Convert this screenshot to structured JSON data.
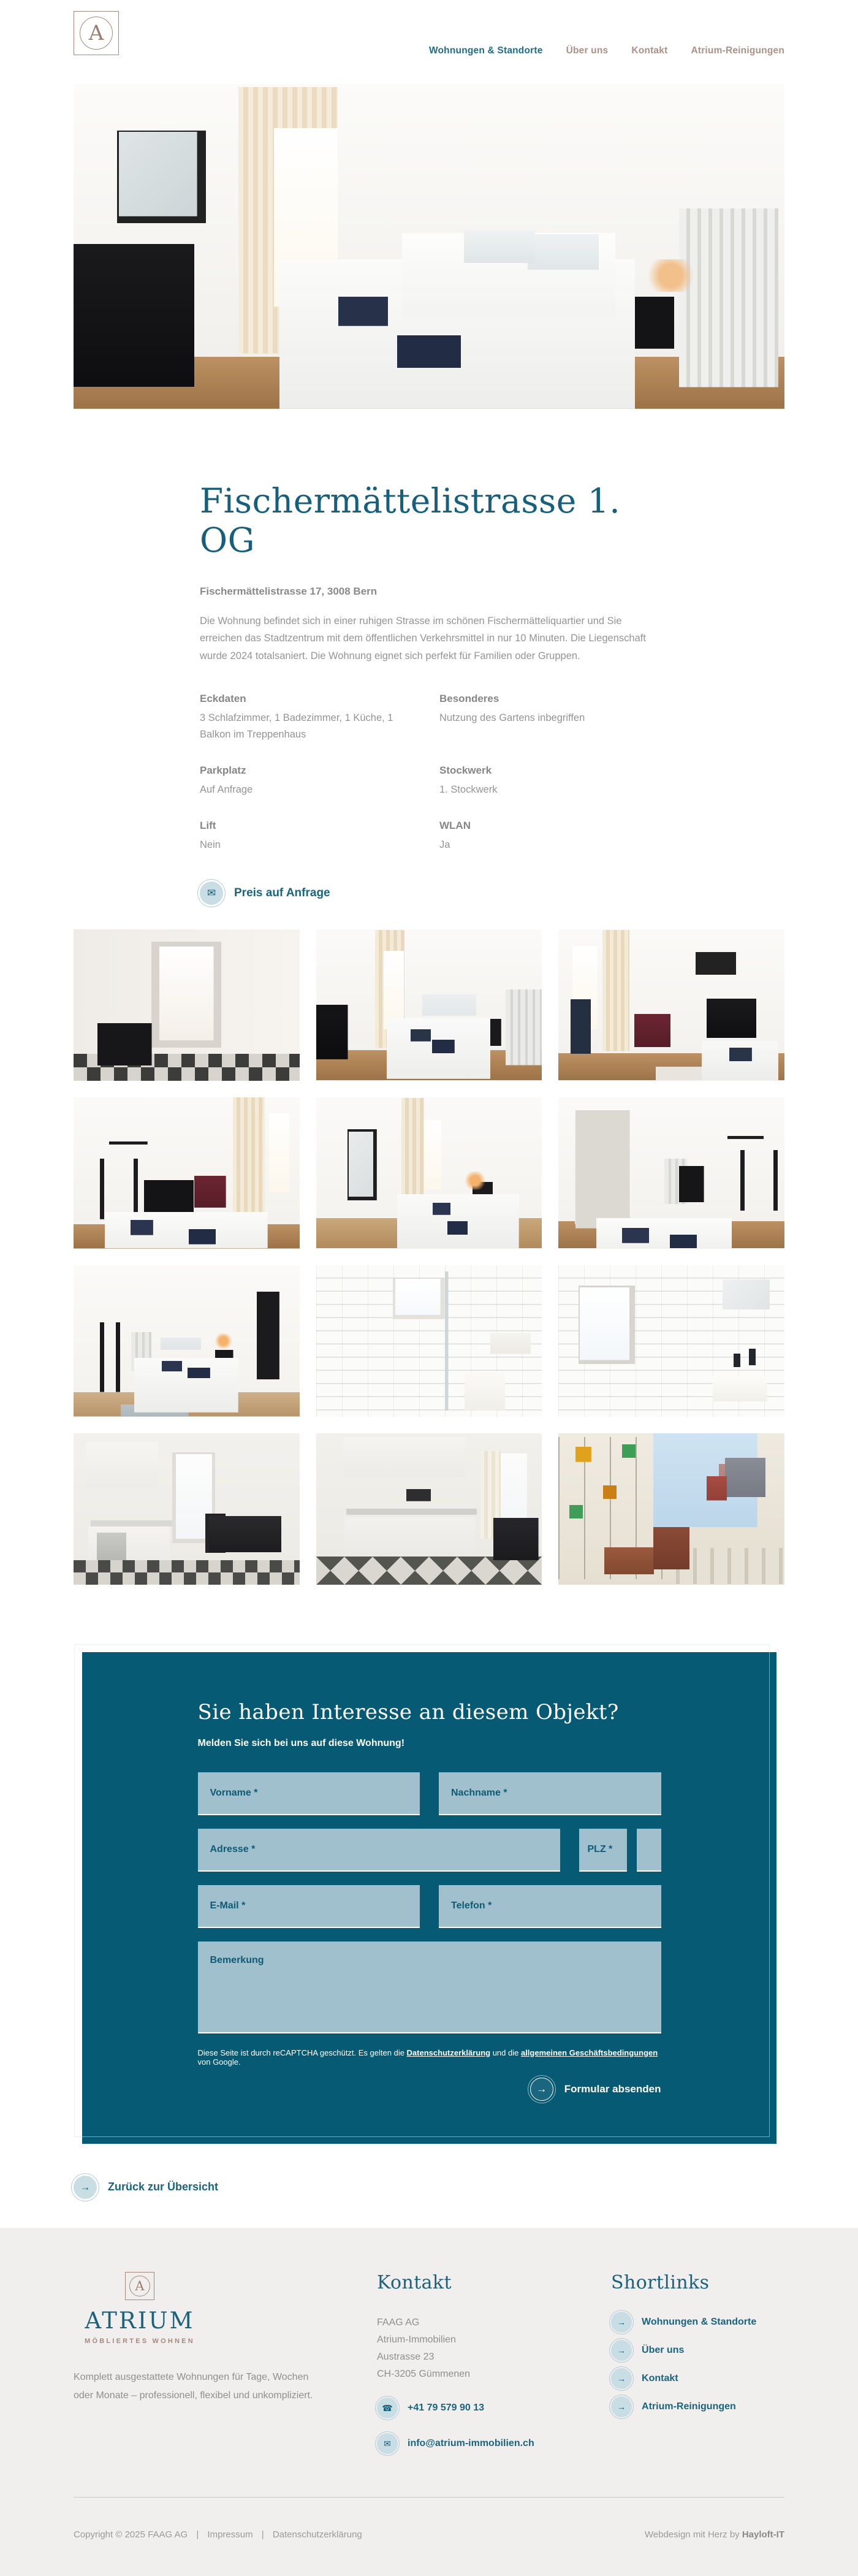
{
  "icons": {
    "envelope": "✉",
    "phone": "☎",
    "arrow": "→",
    "letter": "A"
  },
  "header": {
    "nav": [
      {
        "label": "Wohnungen & Standorte",
        "active": true
      },
      {
        "label": "Über uns",
        "active": false
      },
      {
        "label": "Kontakt",
        "active": false
      },
      {
        "label": "Atrium-Reinigungen",
        "active": false
      }
    ]
  },
  "hero": {
    "alt": "Schlafzimmer mit Doppelbett, schwarzer Kommode, Spiegel und Heizkörper"
  },
  "listing": {
    "title": "Fischermättelistrasse 1. OG",
    "address": "Fischermättelistrasse 17, 3008 Bern",
    "description": "Die Wohnung befindet sich in einer ruhigen Strasse im schönen Fischermätteliquartier und Sie erreichen das Stadtzentrum mit dem öffentlichen Verkehrsmittel in nur 10 Minuten. Die Liegenschaft wurde 2024 totalsaniert. Die Wohnung eignet sich perfekt für Familien oder Gruppen.",
    "details": [
      {
        "label": "Eckdaten",
        "value": "3 Schlafzimmer, 1 Badezimmer, 1 Küche, 1 Balkon im Treppenhaus"
      },
      {
        "label": "Besonderes",
        "value": "Nutzung des Gartens inbegriffen"
      },
      {
        "label": "Parkplatz",
        "value": "Auf Anfrage"
      },
      {
        "label": "Stockwerk",
        "value": "1. Stockwerk"
      },
      {
        "label": "Lift",
        "value": "Nein"
      },
      {
        "label": "WLAN",
        "value": "Ja"
      }
    ],
    "price_button": "Preis auf Anfrage"
  },
  "gallery": {
    "photos": [
      {
        "alt": "Flur mit Schachbrettboden und Konsole"
      },
      {
        "alt": "Schlafzimmer mit Bett und Heizkörper"
      },
      {
        "alt": "Schlafzimmer mit Kommode und rotem Sessel"
      },
      {
        "alt": "Schlafzimmer mit Kleiderständer und Reisebett"
      },
      {
        "alt": "Schlafzimmer mit Standspiegel und Betten"
      },
      {
        "alt": "Zimmer mit Schreibtisch, Stuhl und Kleiderständer"
      },
      {
        "alt": "Schlafzimmer mit Stativleuchte und Spiegel"
      },
      {
        "alt": "Badezimmer mit Dusche und WC"
      },
      {
        "alt": "Badezimmer mit Fenster und Lavabo"
      },
      {
        "alt": "Küche mit Esstisch und Schachbrettboden"
      },
      {
        "alt": "Küche mit Mikrowelle und Backofen"
      },
      {
        "alt": "Balkon mit Buntglasfenster und Holzstuhl"
      }
    ]
  },
  "form": {
    "title": "Sie haben Interesse an diesem Objekt?",
    "subtitle": "Melden Sie sich bei uns auf diese Wohnung!",
    "fields": {
      "vorname": "Vorname *",
      "nachname": "Nachname *",
      "adresse": "Adresse *",
      "plz": "PLZ *",
      "ort": "Ort *",
      "email": "E-Mail *",
      "telefon": "Telefon *",
      "bemerkung": "Bemerkung"
    },
    "recaptcha": {
      "t1": "Diese Seite ist durch reCAPTCHA geschützt. Es gelten die ",
      "link1": "Datenschutzerklärung",
      "t2": " und die ",
      "link2": "allgemeinen Geschäftsbedingungen",
      "t3": " von Google."
    },
    "submit": "Formular absenden"
  },
  "back_link": "Zurück zur Übersicht",
  "footer": {
    "brand_name": "ATRIUM",
    "brand_sub": "MÖBLIERTES WOHNEN",
    "tagline": "Komplett ausgestattete Wohnungen für Tage, Wochen oder Monate – professionell, flexibel und unkompliziert.",
    "kontakt": {
      "heading": "Kontakt",
      "lines": [
        "FAAG AG",
        "Atrium-Immobilien",
        "Austrasse 23",
        "CH-3205 Gümmenen"
      ],
      "phone": "+41 79 579 90 13",
      "email": "info@atrium-immobilien.ch"
    },
    "shortlinks": {
      "heading": "Shortlinks",
      "items": [
        {
          "label": "Wohnungen & Standorte"
        },
        {
          "label": "Über uns"
        },
        {
          "label": "Kontakt"
        },
        {
          "label": "Atrium-Reinigungen"
        }
      ]
    },
    "bottom": {
      "copyright": "Copyright © 2025 FAAG AG",
      "sep": "|",
      "impressum": "Impressum",
      "datenschutz": "Datenschutzerklärung",
      "webdesign_prefix": "Webdesign mit Herz by ",
      "webdesign_brand": "Hayloft-IT"
    }
  }
}
